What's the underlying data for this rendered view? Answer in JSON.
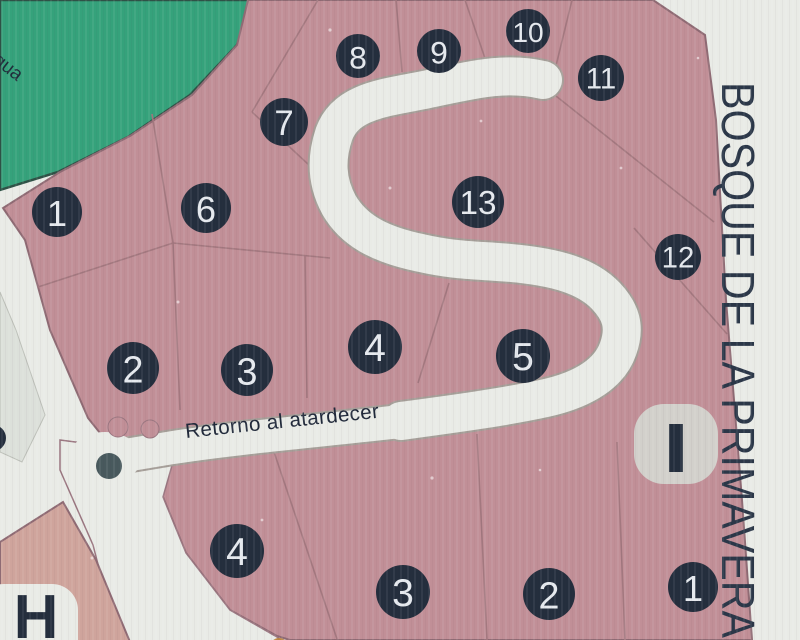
{
  "map": {
    "area_title_vertical": "BOSQUE DE LA PRIMAVERA",
    "street_label": "Retorno al atardecer",
    "green_edge_label": "gua",
    "badges": [
      {
        "id": "I",
        "label": "I"
      },
      {
        "id": "H",
        "label": "H"
      }
    ],
    "lot_markers": [
      {
        "block": "main",
        "label": "1",
        "x": 57,
        "y": 212,
        "r": 25
      },
      {
        "block": "main",
        "label": "2",
        "x": 133,
        "y": 368,
        "r": 26
      },
      {
        "block": "main",
        "label": "3",
        "x": 247,
        "y": 370,
        "r": 26
      },
      {
        "block": "main",
        "label": "4",
        "x": 375,
        "y": 347,
        "r": 27
      },
      {
        "block": "main",
        "label": "5",
        "x": 523,
        "y": 356,
        "r": 27
      },
      {
        "block": "main",
        "label": "6",
        "x": 206,
        "y": 208,
        "r": 25
      },
      {
        "block": "main",
        "label": "7",
        "x": 284,
        "y": 122,
        "r": 24
      },
      {
        "block": "main",
        "label": "8",
        "x": 358,
        "y": 56,
        "r": 22
      },
      {
        "block": "main",
        "label": "9",
        "x": 439,
        "y": 51,
        "r": 22
      },
      {
        "block": "main",
        "label": "10",
        "x": 528,
        "y": 31,
        "r": 22
      },
      {
        "block": "main",
        "label": "11",
        "x": 601,
        "y": 78,
        "r": 23
      },
      {
        "block": "main",
        "label": "12",
        "x": 678,
        "y": 257,
        "r": 23
      },
      {
        "block": "main",
        "label": "13",
        "x": 478,
        "y": 202,
        "r": 26
      },
      {
        "block": "south",
        "label": "4",
        "x": 237,
        "y": 551,
        "r": 27
      },
      {
        "block": "south",
        "label": "3",
        "x": 403,
        "y": 592,
        "r": 27
      },
      {
        "block": "south",
        "label": "2",
        "x": 549,
        "y": 594,
        "r": 26
      },
      {
        "block": "south",
        "label": "1",
        "x": 693,
        "y": 587,
        "r": 25
      },
      {
        "block": "edge",
        "label": "",
        "x": -7,
        "y": 438,
        "r": 13
      }
    ],
    "colors": {
      "background": "#e9ebe6",
      "parcel_pink": "#c18f97",
      "parcel_salmon": "#cfa49c",
      "green_area": "#35a27b",
      "marker_navy": "#242e3d",
      "marker_text": "#e5e9ee",
      "road_white": "#e9ebe6",
      "road_casing": "#a59e98",
      "boundary_line": "#a3787f",
      "badge_gray": "#d2d0cb",
      "dot_slate": "#48595d",
      "accent_yellow": "#bd8845",
      "title_navy": "#2b3748"
    }
  }
}
